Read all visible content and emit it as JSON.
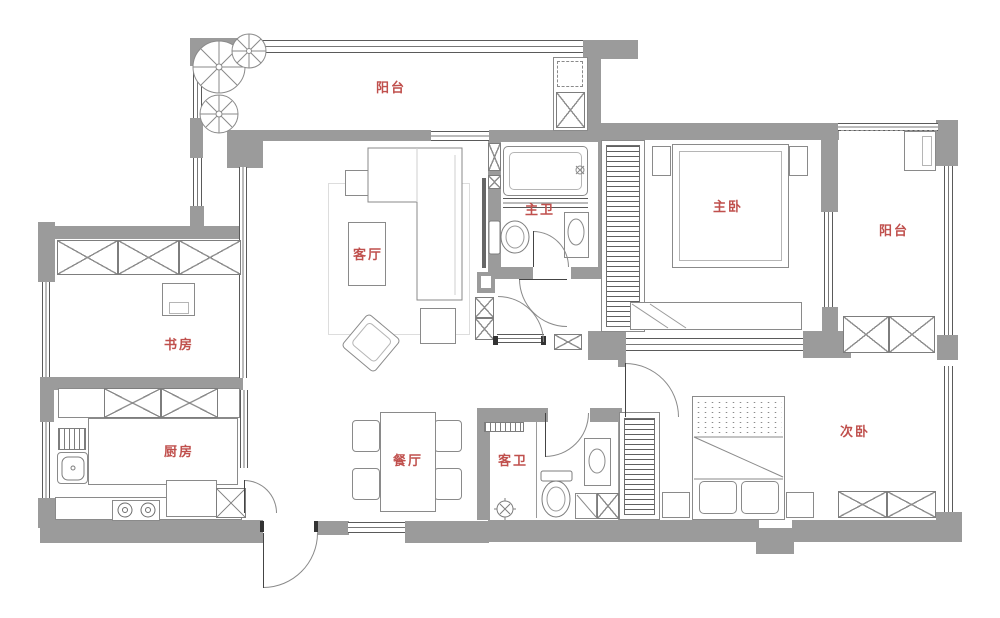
{
  "plan": {
    "colors": {
      "label": "#c0504d",
      "wall": "#9b9b9b",
      "line": "#7d7d7d",
      "background": "#ffffff"
    },
    "rooms": [
      {
        "id": "balcony-top",
        "label": "阳台"
      },
      {
        "id": "living-room",
        "label": "客厅"
      },
      {
        "id": "master-bathroom",
        "label": "主卫"
      },
      {
        "id": "master-bedroom",
        "label": "主卧"
      },
      {
        "id": "balcony-right",
        "label": "阳台"
      },
      {
        "id": "study",
        "label": "书房"
      },
      {
        "id": "kitchen",
        "label": "厨房"
      },
      {
        "id": "dining-room",
        "label": "餐厅"
      },
      {
        "id": "guest-bathroom",
        "label": "客卫"
      },
      {
        "id": "secondary-bedroom",
        "label": "次卧"
      }
    ]
  }
}
